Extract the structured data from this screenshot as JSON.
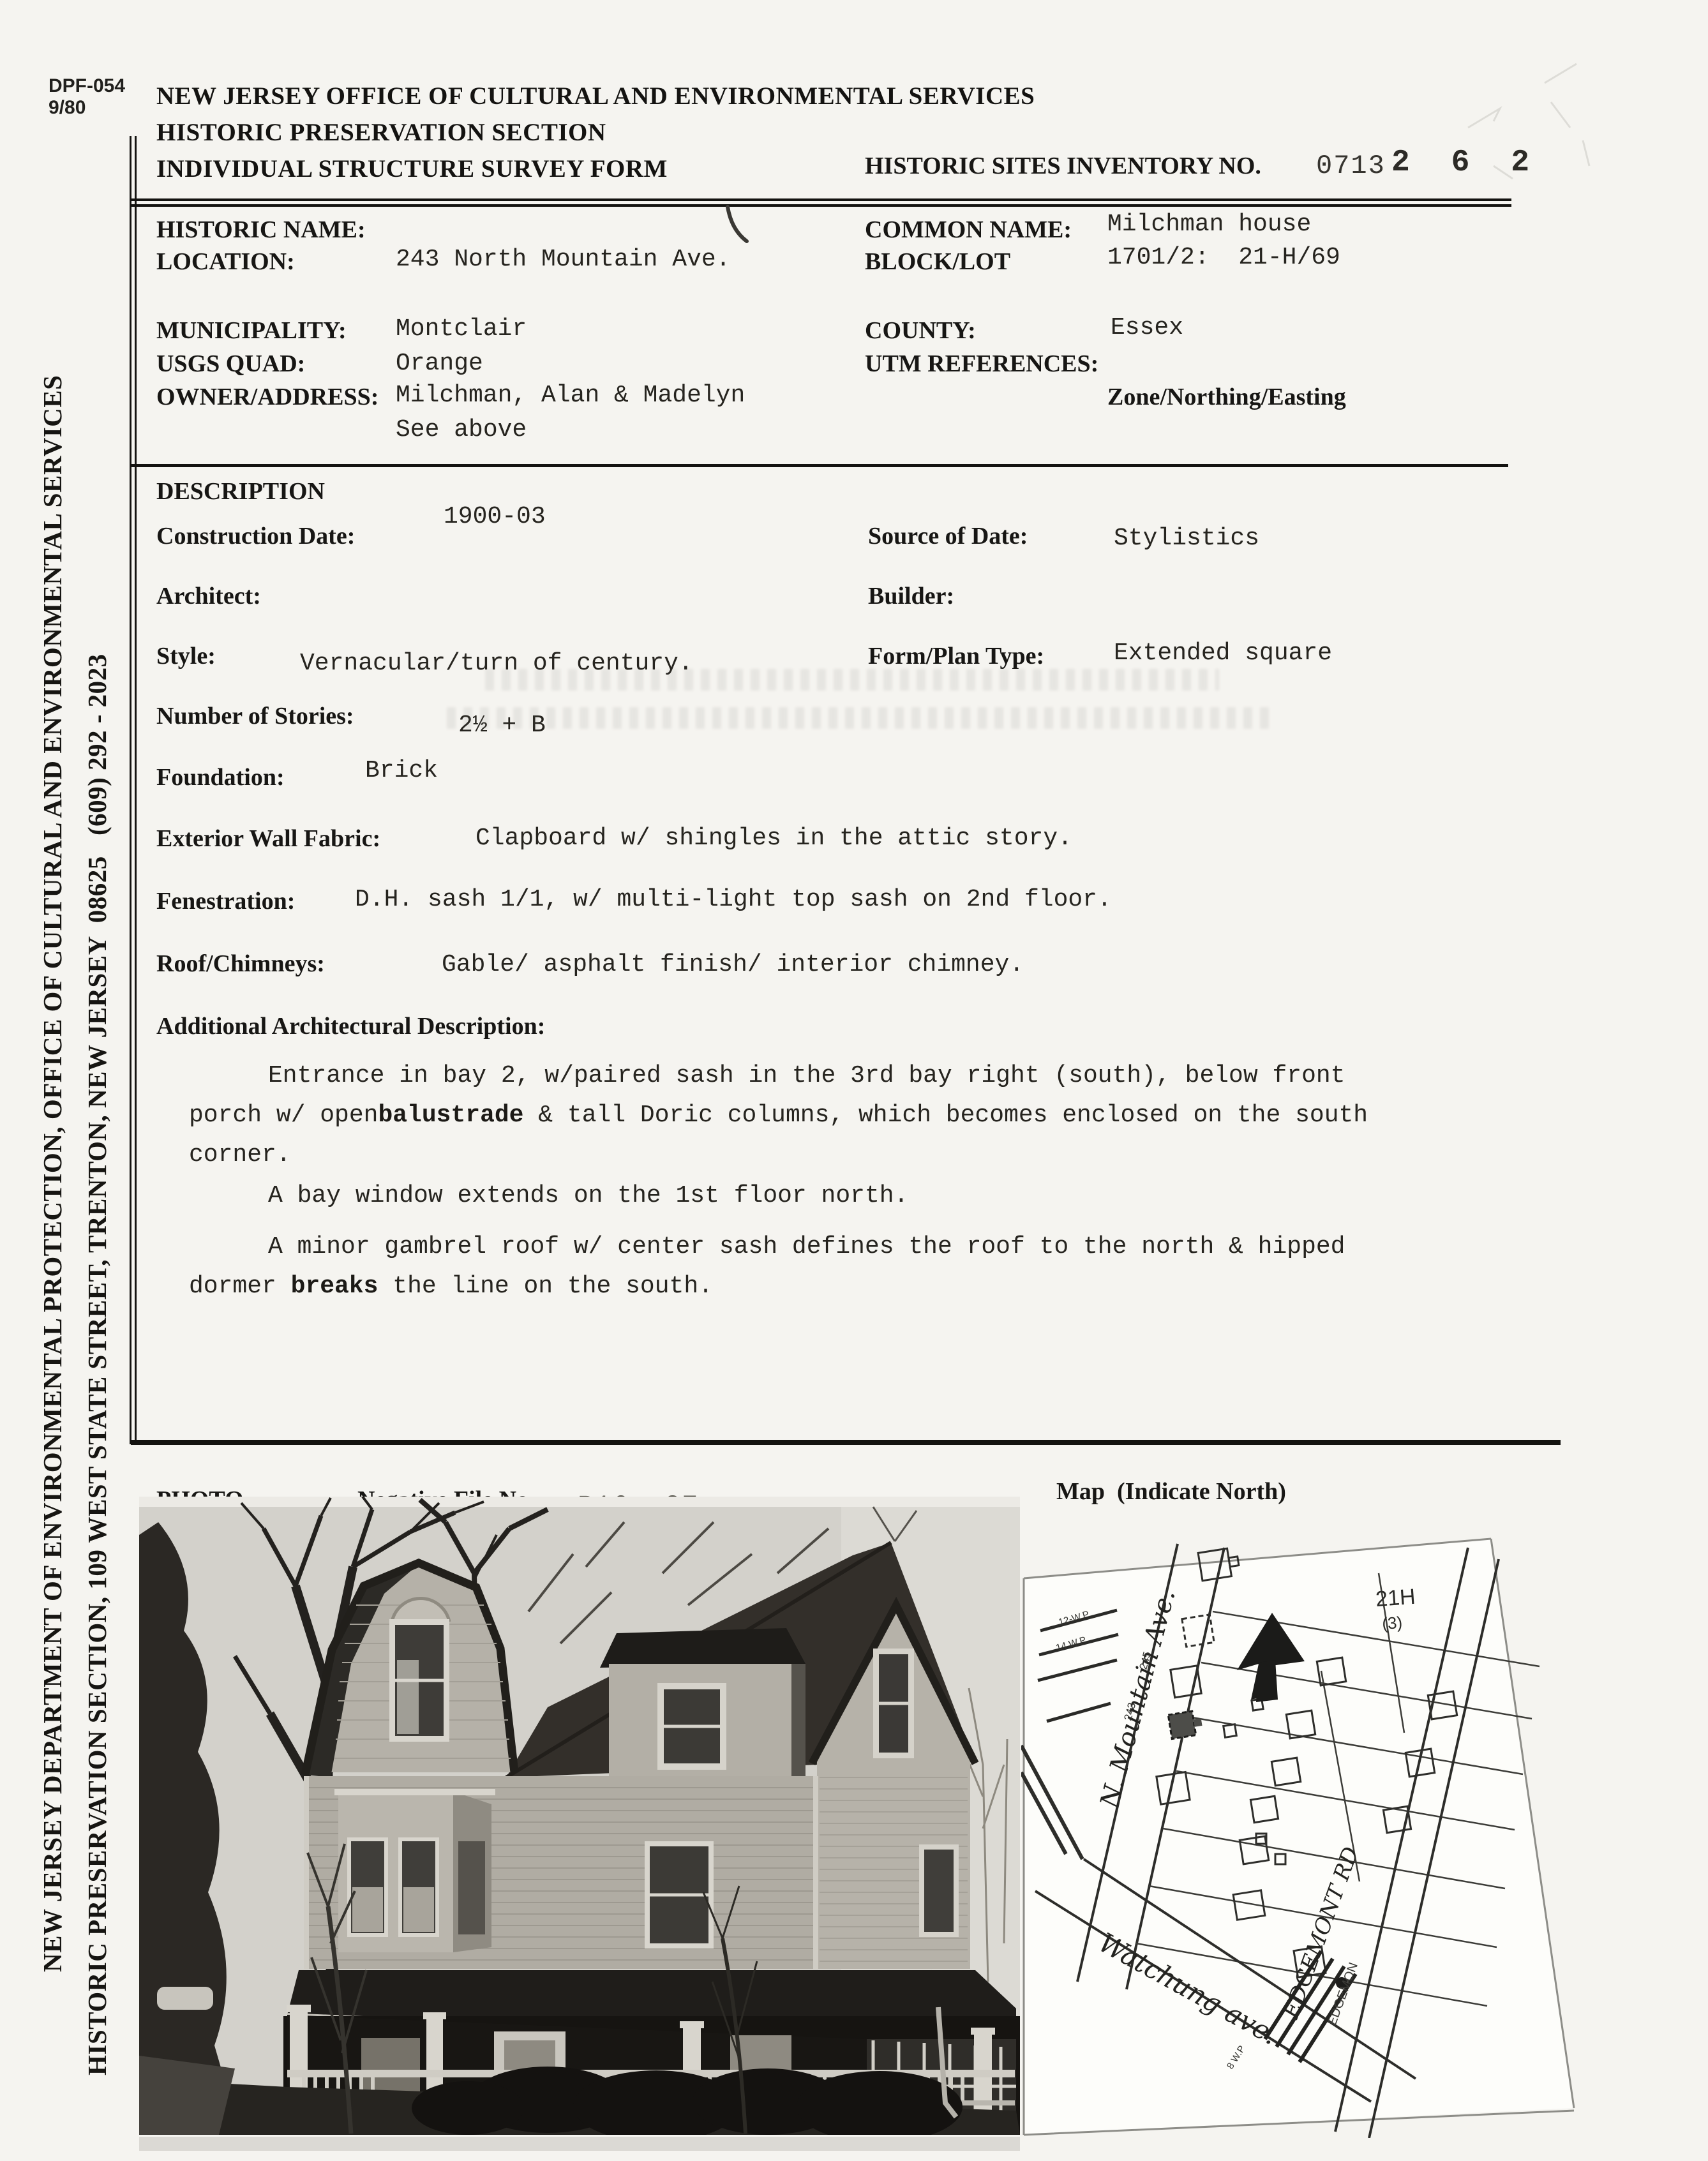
{
  "header": {
    "form_number": "DPF-054",
    "form_rev": "9/80",
    "title1": "NEW JERSEY OFFICE OF CULTURAL AND ENVIRONMENTAL SERVICES",
    "title2": "HISTORIC PRESERVATION SECTION",
    "title3": "INDIVIDUAL STRUCTURE SURVEY FORM",
    "inventory_label": "HISTORIC SITES INVENTORY NO.",
    "inventory_printed": "0713",
    "inventory_stamped": "2 6 2"
  },
  "sidebar": {
    "line1": "NEW JERSEY DEPARTMENT OF ENVIRONMENTAL PROTECTION, OFFICE OF CULTURAL AND ENVIRONMENTAL SERVICES",
    "line2": "HISTORIC PRESERVATION SECTION, 109 WEST STATE STREET, TRENTON, NEW JERSEY  08625   (609) 292 - 2023"
  },
  "id": {
    "historic_name_label": "HISTORIC NAME:",
    "historic_name_value": "",
    "location_label": "LOCATION:",
    "location_value": "243 North Mountain Ave.",
    "common_name_label": "COMMON NAME:",
    "common_name_value": "Milchman house",
    "block_lot_label": "BLOCK/LOT",
    "block_lot_value": "1701/2:  21-H/69",
    "municipality_label": "MUNICIPALITY:",
    "municipality_value": "Montclair",
    "county_label": "COUNTY:",
    "county_value": "Essex",
    "usgs_label": "USGS QUAD:",
    "usgs_value": "Orange",
    "utm_label": "UTM REFERENCES:",
    "utm_sub": "Zone/Northing/Easting",
    "owner_label": "OWNER/ADDRESS:",
    "owner_value": "Milchman, Alan & Madelyn",
    "owner_value2": "See above"
  },
  "desc": {
    "section_title": "DESCRIPTION",
    "construction_date_label": "Construction Date:",
    "construction_date_value": "1900-03",
    "source_label": "Source of Date:",
    "source_value": "Stylistics",
    "architect_label": "Architect:",
    "builder_label": "Builder:",
    "style_label": "Style:",
    "style_value": "Vernacular/turn of century.",
    "form_plan_label": "Form/Plan Type:",
    "form_plan_value": "Extended square",
    "stories_label": "Number of Stories:",
    "stories_value": "2½ + B",
    "foundation_label": "Foundation:",
    "foundation_value": "Brick",
    "wall_label": "Exterior Wall Fabric:",
    "wall_value": "Clapboard w/ shingles in the attic story.",
    "fenestration_label": "Fenestration:",
    "fenestration_value": "D.H. sash 1/1, w/ multi-light top sash on 2nd floor.",
    "roof_label": "Roof/Chimneys:",
    "roof_value": "Gable/ asphalt finish/ interior chimney.",
    "additional_label": "Additional Architectural Description:",
    "para1_line1": "Entrance in bay 2, w/paired sash in the 3rd bay right (south), below front",
    "para1_line2_pre": "porch w/ open",
    "para1_line2_bold": "balustrade",
    "para1_line2_post": " & tall Doric columns, which becomes enclosed on the south",
    "para1_line3": "corner.",
    "para2": "A bay window extends on the 1st floor north.",
    "para3_line1": "A minor gambrel roof w/ center sash defines the roof to the north & hipped",
    "para3_line2_pre": "dormer ",
    "para3_line2_bold": "breaks",
    "para3_line2_post": " the line on the south."
  },
  "photo_section": {
    "photo_label": "PHOTO",
    "negative_label": "Negative File No.",
    "negative_value": "R16, 27",
    "map_label": "Map  (Indicate North)"
  },
  "map": {
    "street_n_mountain": "N. Mountain Ave.",
    "street_watchung": "Watchung ave.",
    "street_edgemont_hand": "EDGEMONT RD",
    "street_edgemont_print": "EDGEMON",
    "block_label": "21H",
    "block_sub": "(3)",
    "house_num_245": "245",
    "house_num_243": "243",
    "wp_label_1": "12-W.P",
    "wp_label_2": "14 W.P",
    "wp_label_3": "8 W.P"
  }
}
